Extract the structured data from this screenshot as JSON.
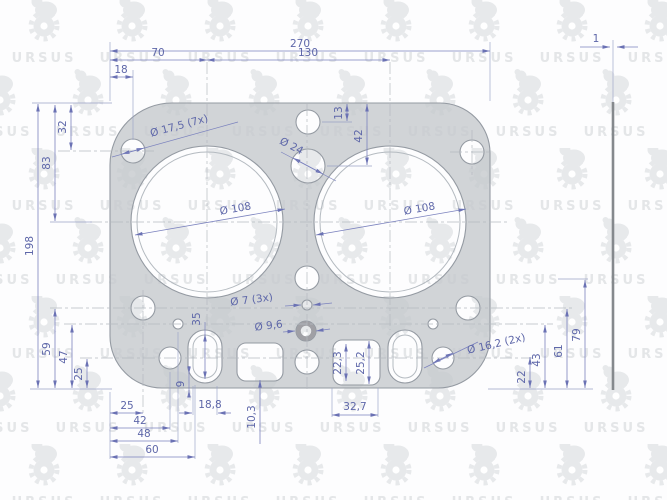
{
  "watermark": {
    "brand": "URSUS"
  },
  "side_view": {
    "thickness": "1"
  },
  "dims": {
    "top": {
      "overall_width": "270",
      "bore_spacing": "130",
      "left_bore_offset": "70",
      "corner_hole_offset": "18"
    },
    "left": {
      "height": "198",
      "bore_center": "83",
      "top_hole": "32",
      "lower_hole_59": "59",
      "lower_hole_47": "47",
      "lower_hole_25": "25"
    },
    "bottom": {
      "chain_25": "25",
      "chain_42": "42",
      "chain_48": "48",
      "chain_60": "60",
      "slot_width": "18,8",
      "passage_offset": "10,3",
      "edge_gap": "9",
      "passage_width": "32,7"
    },
    "right": {
      "h_22": "22",
      "h_43": "43",
      "h_61": "61",
      "h_79": "79"
    },
    "middle": {
      "top_hole_offset": "13",
      "water_hole_offset": "42",
      "slot_height": "35",
      "passage_22_3": "22,3",
      "passage_25_2": "25,2"
    }
  },
  "holes": {
    "bolt_holes": "Ø 17,5 (7x)",
    "water_hole": "Ø 24",
    "bore_left": "Ø 108",
    "bore_right": "Ø 108",
    "small_holes": "Ø 7 (3x)",
    "ring_hole": "Ø 9,6",
    "side_holes": "Ø 16,2 (2x)"
  }
}
